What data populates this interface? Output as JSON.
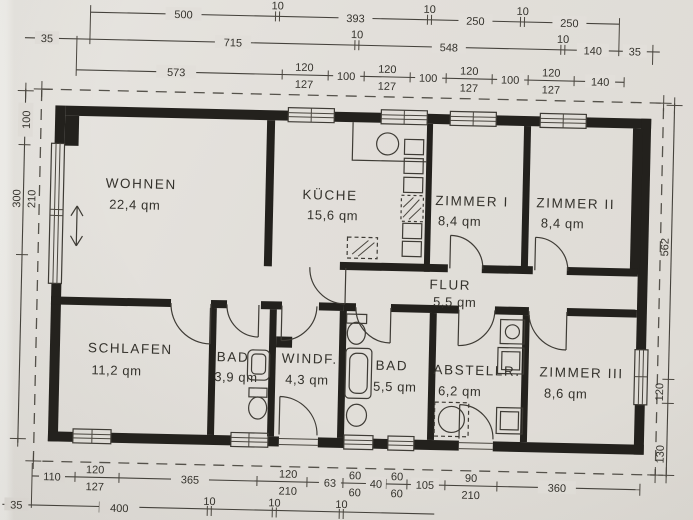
{
  "document": {
    "kind": "floor-plan-scan",
    "area_unit": "qm"
  },
  "colors": {
    "paper": "#e2dfda",
    "wall": "#23211d",
    "line": "#3e3b35",
    "text": "#34322c"
  },
  "rooms": [
    {
      "name": "WOHNEN",
      "area": "22,4 qm"
    },
    {
      "name": "KÜCHE",
      "area": "15,6 qm"
    },
    {
      "name": "ZIMMER I",
      "area": "8,4 qm"
    },
    {
      "name": "ZIMMER II",
      "area": "8,4 qm"
    },
    {
      "name": "FLUR",
      "area": "5,5 qm"
    },
    {
      "name": "SCHLAFEN",
      "area": "11,2 qm"
    },
    {
      "name": "BAD",
      "area": "3,9 qm"
    },
    {
      "name": "WINDF.",
      "area": "4,3 qm"
    },
    {
      "name": "BAD",
      "area": "5,5 qm"
    },
    {
      "name": "ABSTELLR.",
      "area": "6,2 qm"
    },
    {
      "name": "ZIMMER III",
      "area": "8,6 qm"
    }
  ],
  "dims": {
    "t1": [
      "500",
      "10",
      "393",
      "10",
      "250",
      "10",
      "250"
    ],
    "t2": [
      "35",
      "715",
      "10",
      "548",
      "10",
      "140",
      "35"
    ],
    "t3": [
      "573",
      "120",
      "127",
      "100",
      "120",
      "127",
      "100",
      "120",
      "127",
      "100",
      "120",
      "127",
      "140"
    ],
    "left": [
      "100",
      "300",
      "210"
    ],
    "right": [
      "562",
      "120",
      "130"
    ],
    "b1": [
      "110",
      "120",
      "127",
      "365",
      "120",
      "210",
      "63",
      "60",
      "60",
      "40",
      "60",
      "60",
      "105",
      "90",
      "210",
      "360"
    ],
    "b2": [
      "35",
      "400",
      "10",
      "10",
      "10"
    ]
  }
}
